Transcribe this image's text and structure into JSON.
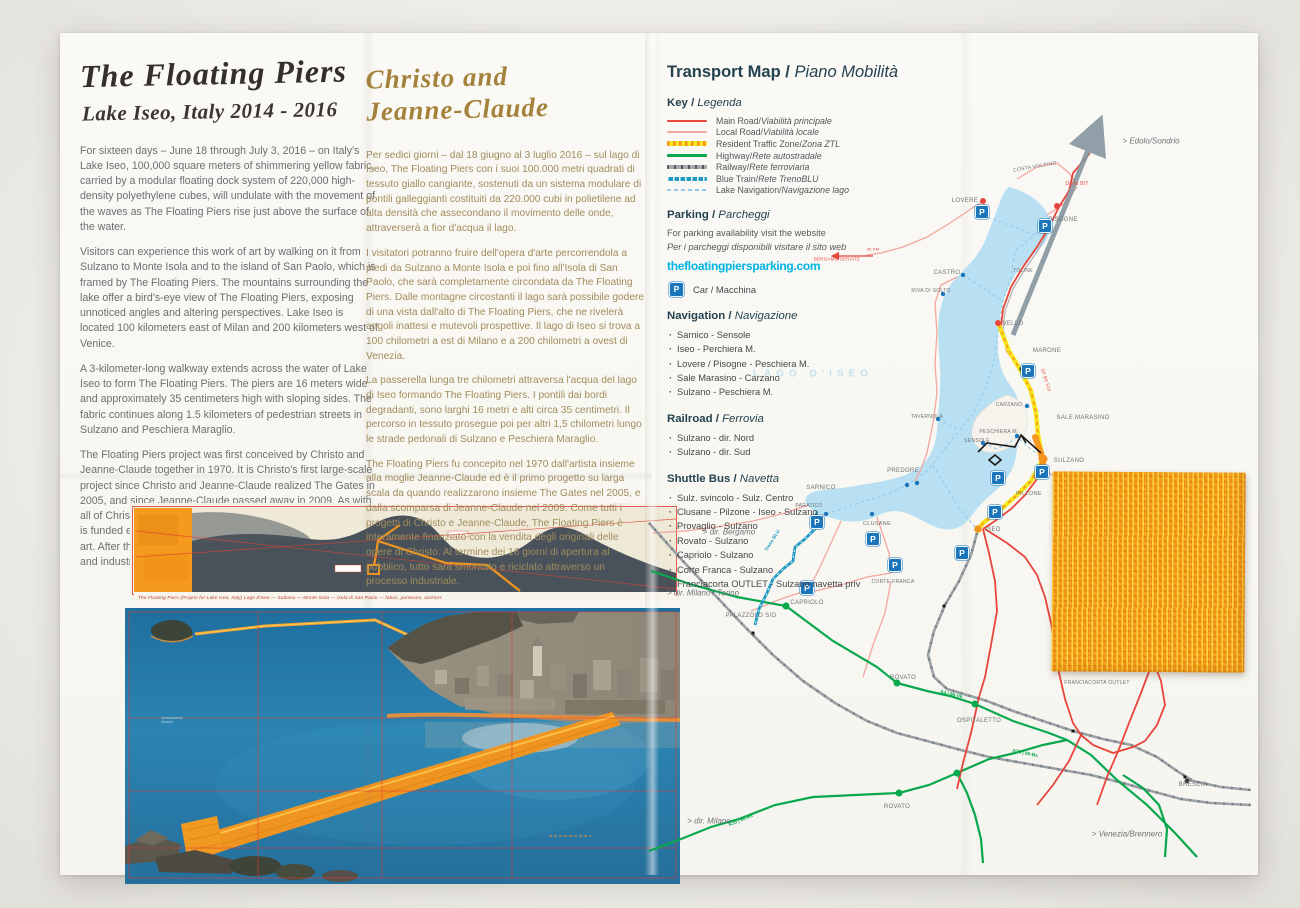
{
  "sep": " / ",
  "left": {
    "title": "The Floating Piers",
    "subtitle": "Lake Iseo, Italy 2014 - 2016",
    "paragraphs": [
      "For sixteen days – June 18 through July 3, 2016 – on Italy's Lake Iseo, 100,000 square meters of shimmering yellow fabric, carried by a modular floating dock system of 220,000 high-density polyethylene cubes, will undulate with the movement of the waves as The Floating Piers rise just above the surface of the water.",
      "Visitors can experience this work of art by walking on it from Sulzano to Monte Isola and to the island of San Paolo, which is framed by The Floating Piers. The mountains surrounding the lake offer a bird's-eye view of The Floating Piers, exposing unnoticed angles and altering perspectives. Lake Iseo is located 100 kilometers east of Milan and 200 kilometers west of Venice.",
      "A 3-kilometer-long walkway extends across the water of Lake Iseo to form The Floating Piers. The piers are 16 meters wide and approximately 35 centimeters high with sloping sides. The fabric continues along 1.5 kilometers of pedestrian streets in Sulzano and Peschiera Maraglio.",
      "The Floating Piers project was first conceived by Christo and Jeanne-Claude together in 1970. It is Christo's first large-scale project since Christo and Jeanne-Claude realized The Gates in 2005, and since Jeanne-Claude passed away in 2009. As with all of Christo and Jeanne-Claude's projects, The Floating Piers is funded entirely through the sale of Christo's original works of art. After the 16-day-exhibition, all components will be removed and industrially recycled."
    ]
  },
  "middle": {
    "title_line1": "Christo and",
    "title_line2": "Jeanne-Claude",
    "paragraphs": [
      "Per sedici giorni – dal 18 giugno al 3 luglio 2016 – sul lago di Iseo, The Floating Piers con i suoi 100.000 metri quadrati di tessuto giallo cangiante, sostenuti da un sistema modulare di pontili galleggianti costituiti da 220.000 cubi in polietilene ad alta densità che assecondano il movimento delle onde, attraverserà a fior d'acqua il lago.",
      "I visitatori potranno fruire dell'opera d'arte percorrendola a piedi da Sulzano a Monte Isola e poi fino all'Isola di San Paolo, che sarà completamente circondata da The Floating Piers. Dalle montagne circostanti il lago sarà possibile godere di una vista dall'alto di The Floating Piers, che ne rivelerà angoli inattesi e mutevoli prospettive. Il lago di Iseo si trova a 100 chilometri a est di Milano e a 200 chilometri a ovest di Venezia.",
      "La passerella lunga tre chilometri attraversa l'acqua del lago di Iseo formando The Floating Piers. I pontili dai bordi degradanti, sono larghi 16 metri e alti circa 35 centimetri. Il percorso in tessuto prosegue poi per altri 1,5 chilometri lungo le strade pedonali di Sulzano e Peschiera Maraglio.",
      "The Floating Piers fu concepito nel 1970 dall'artista insieme alla moglie Jeanne-Claude ed è il primo progetto su larga scala da quando realizzarono insieme The Gates nel 2005, e dalla scomparsa di Jeanne-Claude nel 2009. Come tutti i progetti di Christo e Jeanne-Claude, The Floating Piers è interamente finanziato con la vendita degli originali delle opere di Christo. Al termine dei 16 giorni di apertura al pubblico, tutto sarà smontato e riciclato attraverso un processo industriale."
    ]
  },
  "transport": {
    "title_en": "Transport Map",
    "title_it": "Piano Mobilità",
    "key": {
      "en": "Key",
      "it": "Legenda",
      "items": [
        {
          "en": "Main Road",
          "it": "Viabilità principale"
        },
        {
          "en": "Local Road",
          "it": "Viabilità locale"
        },
        {
          "en": "Resident Traffic Zone",
          "it": "Zona ZTL"
        },
        {
          "en": "Highway",
          "it": "Rete autostradale"
        },
        {
          "en": "Railway",
          "it": "Rete ferroviaria"
        },
        {
          "en": "Blue Train",
          "it": "Rete TrenoBLU"
        },
        {
          "en": "Lake Navigation",
          "it": "Navigazione lago"
        }
      ]
    },
    "parking": {
      "en": "Parking",
      "it": "Parcheggi",
      "line1": "For parking availability visit the website",
      "line2": "Per i parcheggi disponibili visitare il sito web",
      "website": "thefloatingpiersparking.com",
      "car_label": "Car / Macchina"
    },
    "navigation": {
      "en": "Navigation",
      "it": "Navigazione",
      "items": [
        "Sarnico - Sensole",
        "Iseo - Perchiera M.",
        "Lovere / Pisogne - Peschiera M.",
        "Sale Marasino - Carzano",
        "Sulzano - Peschiera M."
      ]
    },
    "railroad": {
      "en": "Railroad",
      "it": "Ferrovia",
      "items": [
        "Sulzano - dir. Nord",
        "Sulzano - dir. Sud"
      ]
    },
    "shuttle": {
      "en": "Shuttle Bus",
      "it": "Navetta",
      "items": [
        "Sulz. svincolo - Sulz. Centro",
        "Clusane - Pilzone - Iseo - Sulzano",
        "Provaglio - Sulzano",
        "Rovato - Sulzano",
        "Capriolo - Sulzano",
        "Corte Franca - Sulzano",
        "Franciacorta OUTLET - Sulzano navetta priv"
      ]
    }
  },
  "artwork": {
    "drawing_caption": "The Floating Piers (Project for Lake Iseo, Italy)  Lago d'Iseo — Sulzano — Monte Isola — Isola di San Paolo — fabric, pontoons, anchors"
  },
  "map": {
    "p_glyph": "P",
    "colors": {
      "accent_cyan": "#00b5e2",
      "main_road": "#e8453c",
      "local_road": "#f2a79f",
      "ztl_yellow": "#f6e71d",
      "highway_green": "#09a84e",
      "railway_gray": "#9aa0a3",
      "blue_train": "#1f9ac2",
      "lake_nav": "#90c9e8",
      "lake_fill": "#b9e0f2",
      "parking_blue": "#1b75bb",
      "fabric_orange": "#f59a1c"
    },
    "labels": [
      {
        "t": "COSTA VOLPINO",
        "x": 390,
        "y": 134,
        "c": "town",
        "r": -10,
        "s": 5
      },
      {
        "t": "LOVERE",
        "x": 320,
        "y": 168,
        "c": "town"
      },
      {
        "t": "PISOGNE",
        "x": 418,
        "y": 187,
        "c": "town"
      },
      {
        "t": "CASTRO",
        "x": 302,
        "y": 240,
        "c": "town"
      },
      {
        "t": "RIVA DI SOLTO",
        "x": 286,
        "y": 258,
        "c": "town",
        "s": 5
      },
      {
        "t": "TOLINE",
        "x": 378,
        "y": 238,
        "c": "town",
        "s": 5
      },
      {
        "t": "VELLO",
        "x": 368,
        "y": 291,
        "c": "town"
      },
      {
        "t": "MARONE",
        "x": 402,
        "y": 318,
        "c": "town"
      },
      {
        "t": "TAVERNOLA",
        "x": 282,
        "y": 384,
        "c": "town",
        "s": 5
      },
      {
        "t": "CARZANO",
        "x": 364,
        "y": 372,
        "c": "town",
        "s": 5
      },
      {
        "t": "SALE MARASINO",
        "x": 438,
        "y": 385,
        "c": "town"
      },
      {
        "t": "PESCHIERA M.",
        "x": 354,
        "y": 399,
        "c": "town",
        "s": 5
      },
      {
        "t": "SENSOLE",
        "x": 332,
        "y": 408,
        "c": "town",
        "s": 5
      },
      {
        "t": "SULZANO",
        "x": 424,
        "y": 428,
        "c": "town"
      },
      {
        "t": "PILZONE",
        "x": 384,
        "y": 461,
        "c": "town",
        "s": 5.5
      },
      {
        "t": "ISEO",
        "x": 348,
        "y": 497,
        "c": "town"
      },
      {
        "t": "PREDORE",
        "x": 258,
        "y": 438,
        "c": "town"
      },
      {
        "t": "SARNICO",
        "x": 176,
        "y": 455,
        "c": "town"
      },
      {
        "t": "PARATICO",
        "x": 164,
        "y": 473,
        "c": "town",
        "s": 5
      },
      {
        "t": "CLUSANE",
        "x": 232,
        "y": 491,
        "c": "town",
        "s": 5.5
      },
      {
        "t": "CORTE FRANCA",
        "x": 248,
        "y": 549,
        "c": "town",
        "s": 5
      },
      {
        "t": "CAPRIOLO",
        "x": 162,
        "y": 570,
        "c": "town"
      },
      {
        "t": "PALAZZOLO S/O",
        "x": 106,
        "y": 583,
        "c": "town"
      },
      {
        "t": "ROVATO",
        "x": 258,
        "y": 645,
        "c": "town"
      },
      {
        "t": "ROVATO",
        "x": 252,
        "y": 774,
        "c": "town"
      },
      {
        "t": "OSPITALETTO",
        "x": 334,
        "y": 688,
        "c": "town"
      },
      {
        "t": "FRANCIACORTA OUTLET",
        "x": 452,
        "y": 650,
        "c": "town",
        "s": 5
      },
      {
        "t": "BRESCIA",
        "x": 548,
        "y": 752,
        "c": "town"
      },
      {
        "t": "> Edolo/Sondrio",
        "x": 506,
        "y": 108,
        "c": "dir"
      },
      {
        "t": "> dir. Bergamo",
        "x": 84,
        "y": 499,
        "c": "dir"
      },
      {
        "t": "> dir. Milano / Torino",
        "x": 58,
        "y": 560,
        "c": "dir"
      },
      {
        "t": "> dir. Milano",
        "x": 64,
        "y": 788,
        "c": "dir"
      },
      {
        "t": "> Venezia/Brennero",
        "x": 482,
        "y": 801,
        "c": "dir"
      },
      {
        "t": "Darfo B/T",
        "x": 432,
        "y": 151,
        "c": "red"
      },
      {
        "t": "BERGAMO/SERIATE",
        "x": 192,
        "y": 226,
        "c": "red",
        "s": 4.5
      },
      {
        "t": "35 KM",
        "x": 228,
        "y": 216,
        "c": "red",
        "s": 4
      },
      {
        "t": "SP BS 510",
        "x": 401,
        "y": 347,
        "c": "red",
        "r": 72,
        "s": 4.5
      },
      {
        "t": "Treno BLU",
        "x": 128,
        "y": 508,
        "c": "blue",
        "r": -58
      },
      {
        "t": "A4 | Mi-Ve",
        "x": 306,
        "y": 662,
        "c": "green",
        "r": 13
      },
      {
        "t": "A35 | Mi-Bs",
        "x": 380,
        "y": 721,
        "c": "green",
        "r": 12
      },
      {
        "t": "A35 | Mi-Bs",
        "x": 96,
        "y": 788,
        "c": "green",
        "r": -22
      },
      {
        "t": "LAGO D'ISEO",
        "x": 168,
        "y": 341,
        "c": "ghost"
      }
    ],
    "parkings": [
      [
        337,
        179
      ],
      [
        400,
        193
      ],
      [
        383,
        338
      ],
      [
        353,
        445
      ],
      [
        397,
        439
      ],
      [
        350,
        479
      ],
      [
        317,
        520
      ],
      [
        228,
        506
      ],
      [
        250,
        532
      ],
      [
        172,
        489
      ],
      [
        162,
        555
      ]
    ]
  }
}
